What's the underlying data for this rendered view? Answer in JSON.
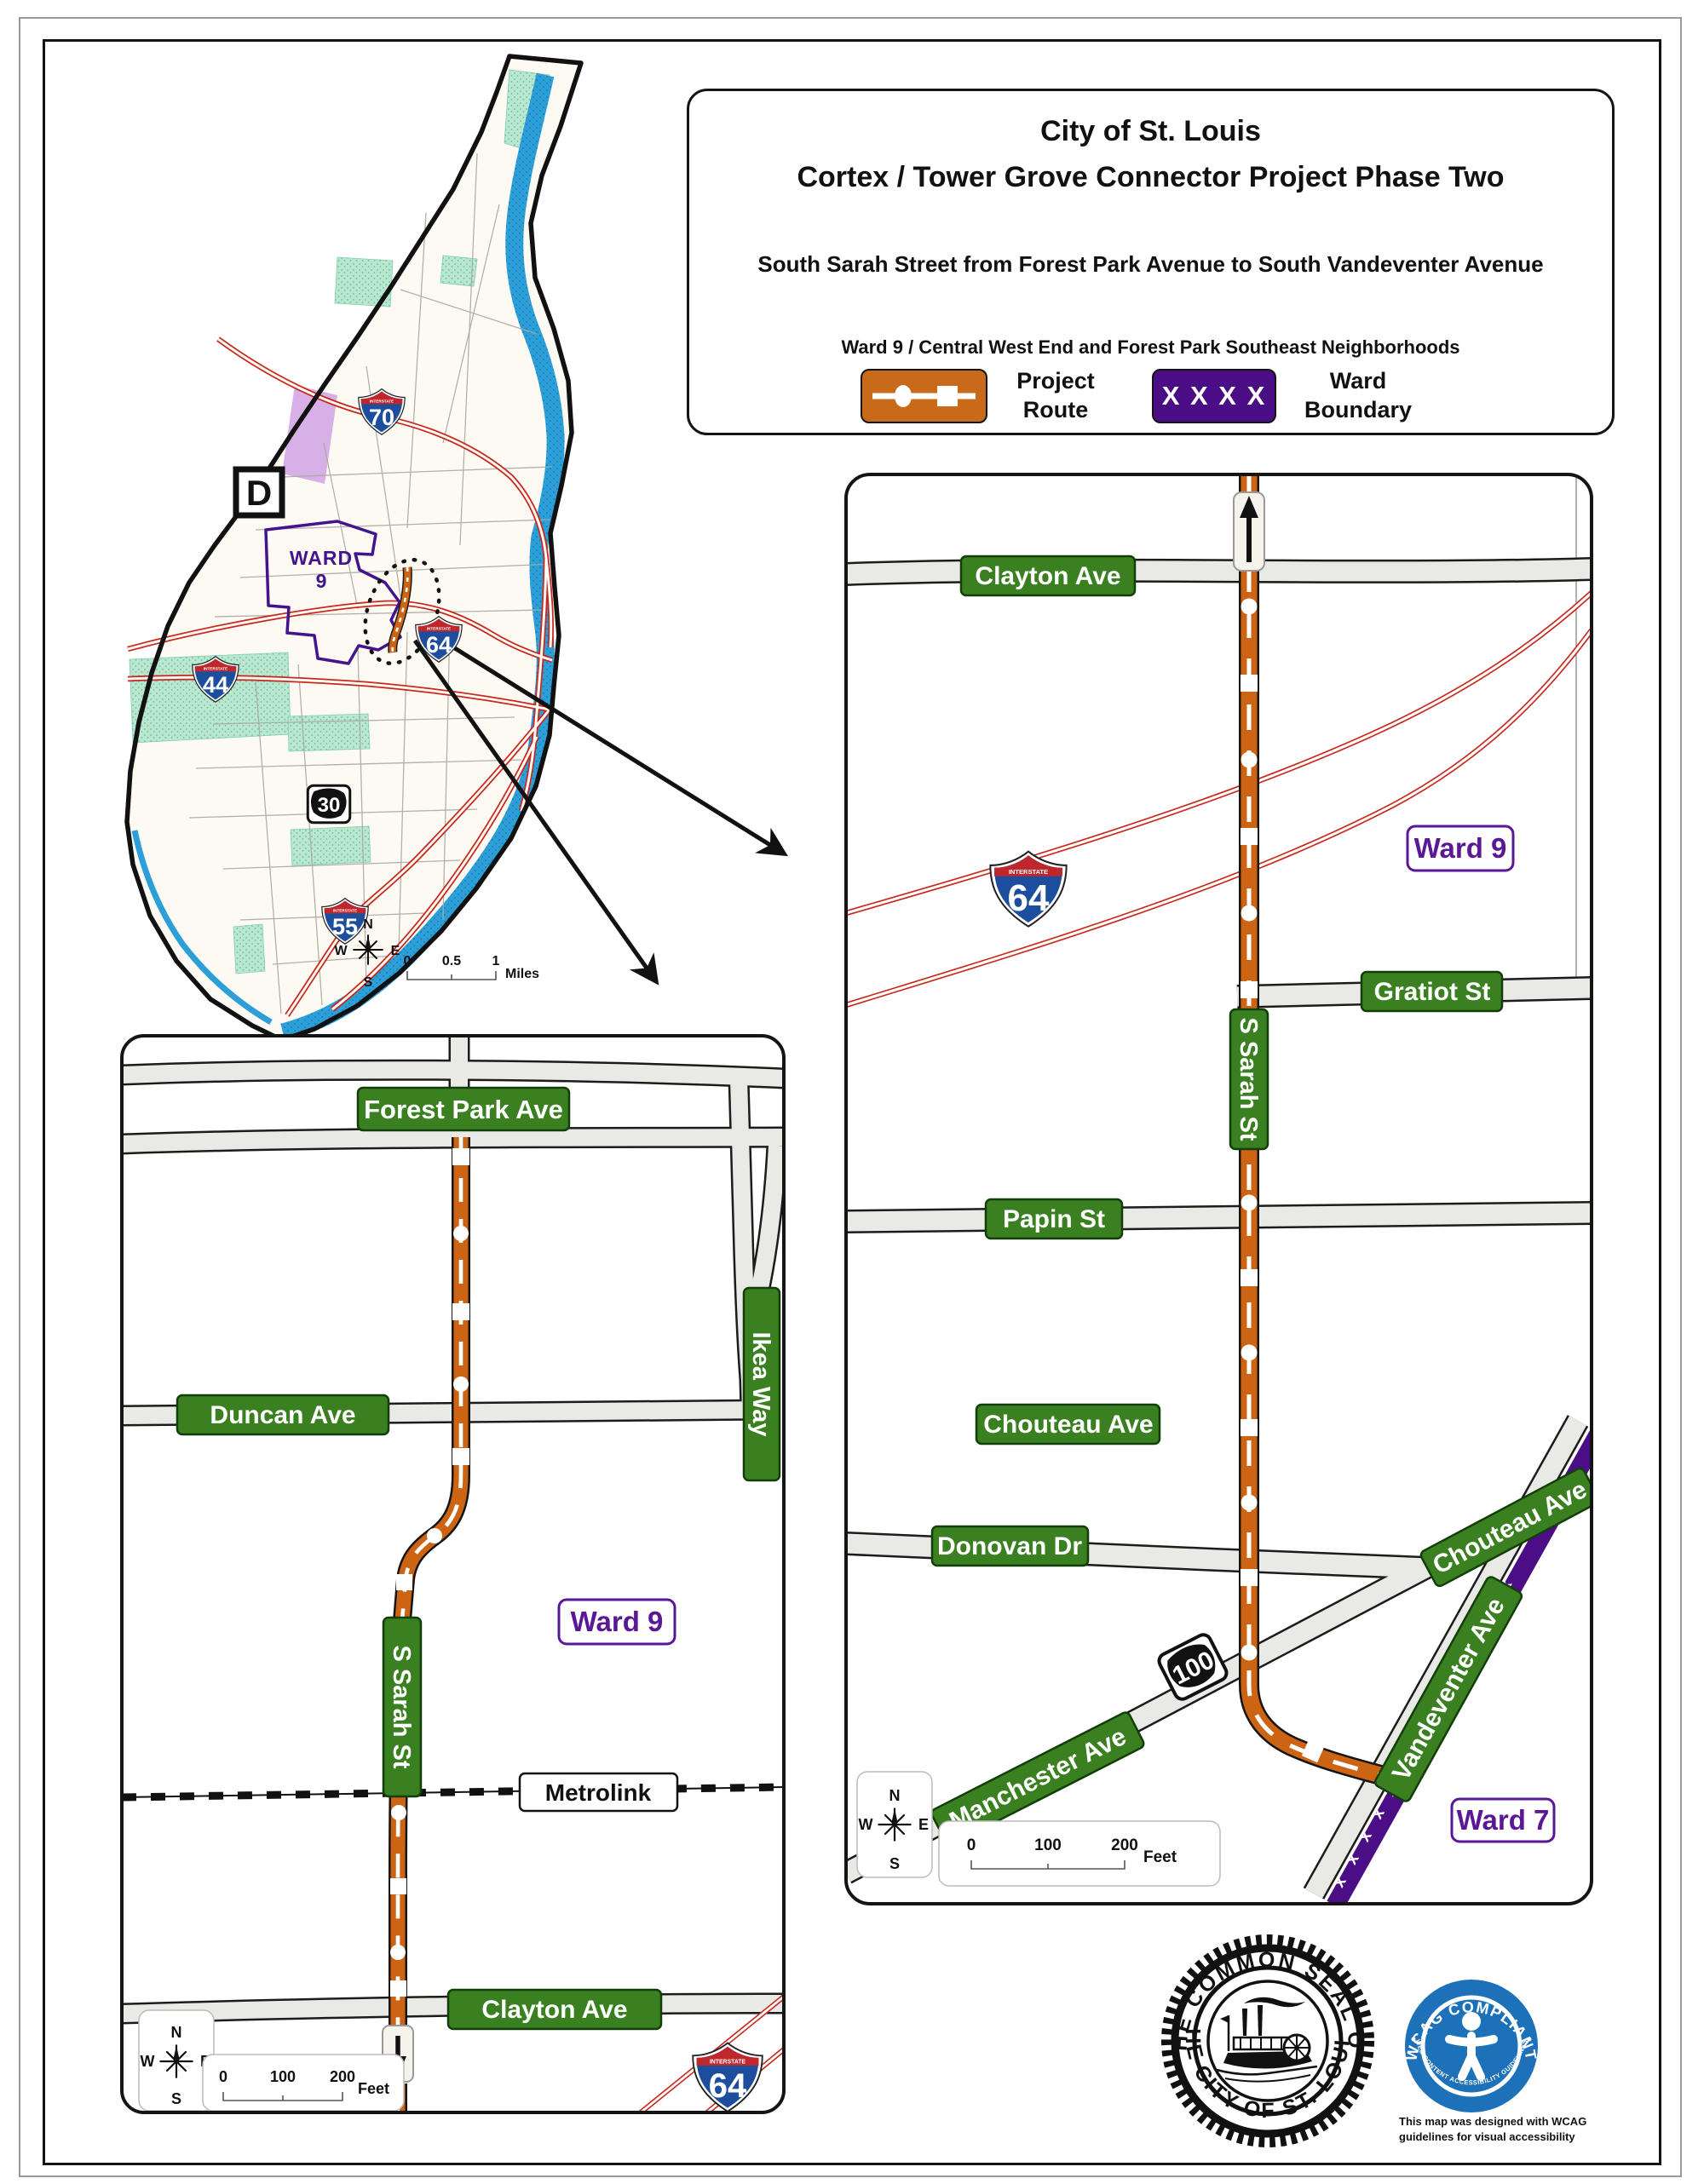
{
  "title_box": {
    "title1": "City of St. Louis",
    "title2": "Cortex / Tower Grove Connector Project Phase Two",
    "subtitle": "South Sarah Street from Forest Park Avenue to South Vandeventer Avenue",
    "neighborhoods": "Ward 9 / Central West End and Forest Park Southeast Neighborhoods",
    "legend": {
      "project_route_label": "Project Route",
      "ward_boundary_label": "Ward Boundary",
      "ward_boundary_symbol": "X X X X"
    }
  },
  "shared": {
    "interstate_caption": "INTERSTATE",
    "compass": {
      "n": "N",
      "e": "E",
      "s": "S",
      "w": "W"
    },
    "feet_scale": {
      "f0": "0",
      "f1": "100",
      "f2": "200",
      "unit": "Feet"
    }
  },
  "overview_map": {
    "d_label": "D",
    "ward_line1": "WARD",
    "ward_line2": "9",
    "shield_70": "70",
    "shield_64": "64",
    "shield_44": "44",
    "shield_55": "55",
    "route_30": "30",
    "scale": {
      "m0": "0",
      "m1": "0.5",
      "m2": "1",
      "unit": "Miles"
    }
  },
  "right_map": {
    "clayton": "Clayton Ave",
    "gratiot": "Gratiot St",
    "sarah": "S Sarah St",
    "papin": "Papin St",
    "chouteau_h": "Chouteau Ave",
    "donovan": "Donovan Dr",
    "chouteau_r": "Chouteau Ave",
    "manchester": "Manchester Ave",
    "vandeventer": "Vandeventer Ave",
    "ward9": "Ward 9",
    "ward7": "Ward 7",
    "shield_64": "64",
    "route_100": "100",
    "boundary_x_pattern": "x x x x x x x x x x x x x x x"
  },
  "left_map": {
    "forest_park": "Forest Park Ave",
    "ikea": "Ikea Way",
    "duncan": "Duncan Ave",
    "ward9": "Ward 9",
    "sarah": "S Sarah St",
    "metrolink": "Metrolink",
    "clayton": "Clayton Ave",
    "shield_64": "64"
  },
  "seal": {
    "arc_top": "THE COMMON SEAL OF",
    "arc_bottom": "THE CITY OF ST. LOUIS."
  },
  "wcag": {
    "arc_top": "WCAG COMPLIANT",
    "arc_bottom": "WEB CONTENT ACCESSIBILITY GUIDELINES",
    "caption_line1": "This map was designed with WCAG",
    "caption_line2": "guidelines for visual accessibility"
  },
  "colors": {
    "route_orange": "#CD6414",
    "ward_purple": "#4B0D86",
    "sign_green": "#3A8020",
    "river_blue": "#2D9FD8",
    "interstate_blue": "#1D4E9E",
    "interstate_red": "#C0272D",
    "highway_red": "#C8281E",
    "park_green": "#B9E7CF"
  }
}
